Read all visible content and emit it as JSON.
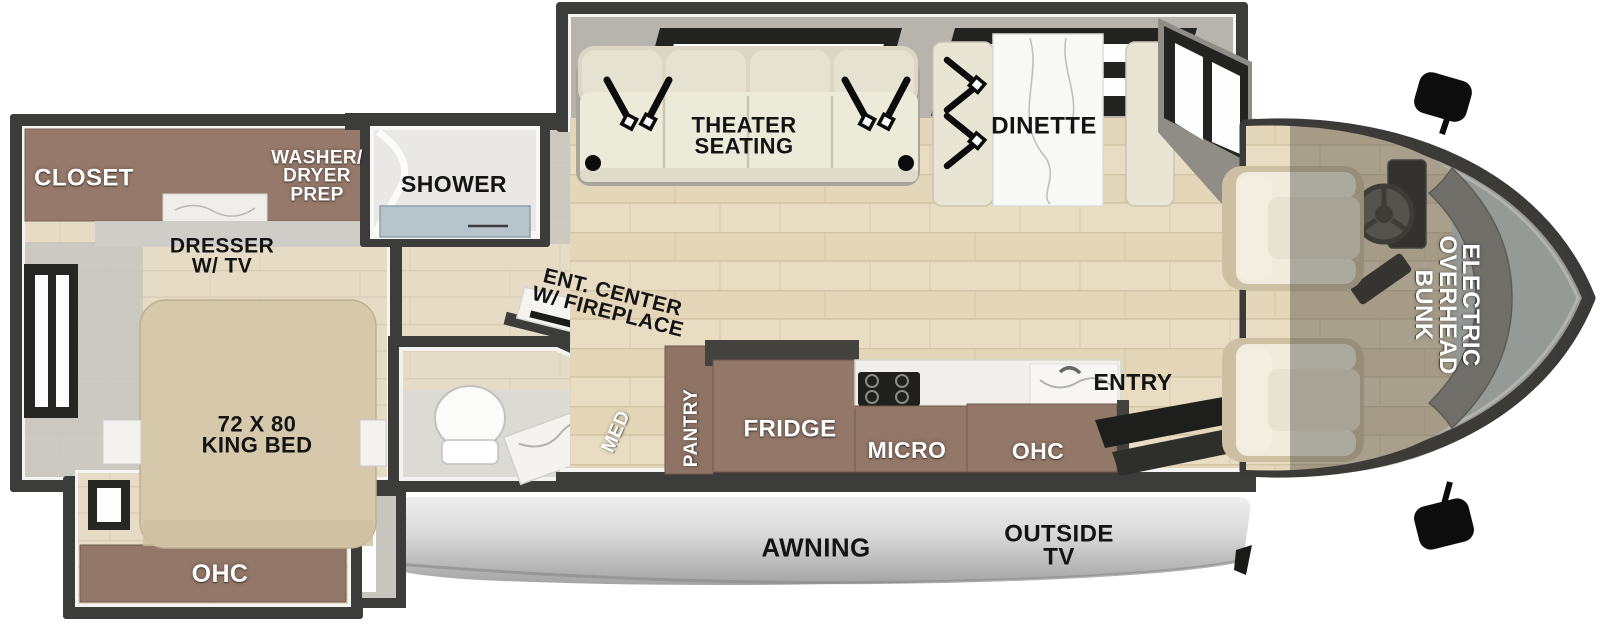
{
  "floorplan": {
    "labels": {
      "closet": "CLOSET",
      "washer_dryer_prep": "WASHER/\nDRYER\nPREP",
      "shower": "SHOWER",
      "dresser_tv": "DRESSER\nW/ TV",
      "king_bed": "72 X 80\nKING BED",
      "bedroom_ohc": "OHC",
      "ent_center": "ENT. CENTER\nW/ FIREPLACE",
      "med": "MED",
      "pantry": "PANTRY",
      "fridge": "FRIDGE",
      "micro": "MICRO",
      "kitchen_ohc": "OHC",
      "entry": "ENTRY",
      "awning": "AWNING",
      "outside_tv": "OUTSIDE\nTV",
      "theater_seating": "THEATER\nSEATING",
      "dinette": "DINETTE",
      "overhead_bunk": "ELECTRIC\nOVERHEAD\nBUNK"
    },
    "colors": {
      "wall": "#3c3c3a",
      "wood_floor": "#e8dcc2",
      "cabinet_brown": "#937768",
      "seat_cream": "#ece9d9",
      "slide_gray": "#b6b4ad",
      "shower_pan": "#b7c4cc",
      "awning_gray": "#d8d8d8",
      "windshield": "#cbd4d1",
      "label_white": "#ffffff",
      "label_black": "#141414"
    }
  }
}
